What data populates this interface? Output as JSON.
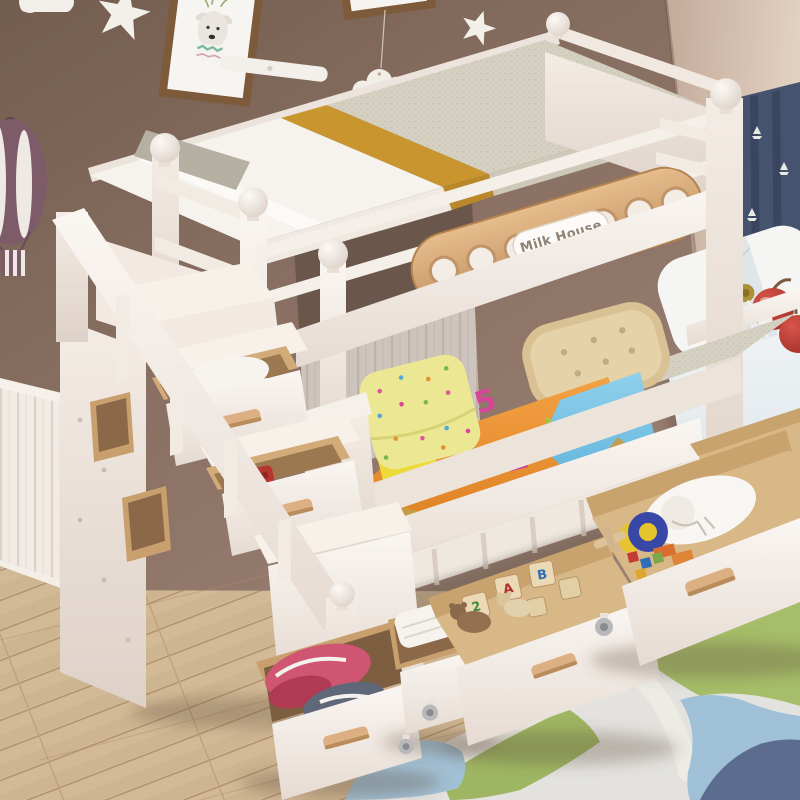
{
  "scene": {
    "description": "Product photo of a white kids bunk bed with storage staircase drawers, pull-out under-bed drawers holding toys and folded clothes, colorful bedding, in a children's bedroom with taupe walls, white wainscoting, light wood floor and a pastel area rug",
    "bed": {
      "type": "bunk-bed",
      "plaque_label": "Milk House",
      "comforter_print": [
        "5",
        "2",
        "4",
        "b"
      ],
      "block_letters": [
        "A",
        "B",
        "2"
      ]
    },
    "decor": {
      "items": [
        "picture-frame-deer",
        "wall-shelf",
        "paper-cloud-decal",
        "star-decals",
        "cloud-mobile",
        "hot-air-balloon-decal",
        "sailboat-curtain",
        "window-bench-pillow",
        "cherry-plush"
      ]
    },
    "palette": {
      "wall_left": "#8a7163",
      "wall_right": "#d3bfae",
      "wainscot": "#f1eae3",
      "floor_wood": "#d2b894",
      "rug_base": "#e3e2de",
      "rug_green": "#a6bd69",
      "rug_blue": "#a2c0d4",
      "rug_navy": "#5c6c8f",
      "bed_frame_white": "#f4eee8",
      "wood_accent": "#d2a977",
      "mattress_tweed": "#d2cdbe",
      "duvet_white": "#f6f3ee",
      "stripe_gold": "#c8952f",
      "comforter_orange": "#e88a2d",
      "comforter_blue": "#6fc0e4",
      "comforter_khaki": "#c59b45",
      "pillow_polka_yellow": "#ebe793",
      "pillow_tufted_tan": "#e6d2a8",
      "curtain_navy": "#46536e",
      "toy_red": "#b8352f",
      "balloon_plum": "#7d5b68"
    }
  }
}
